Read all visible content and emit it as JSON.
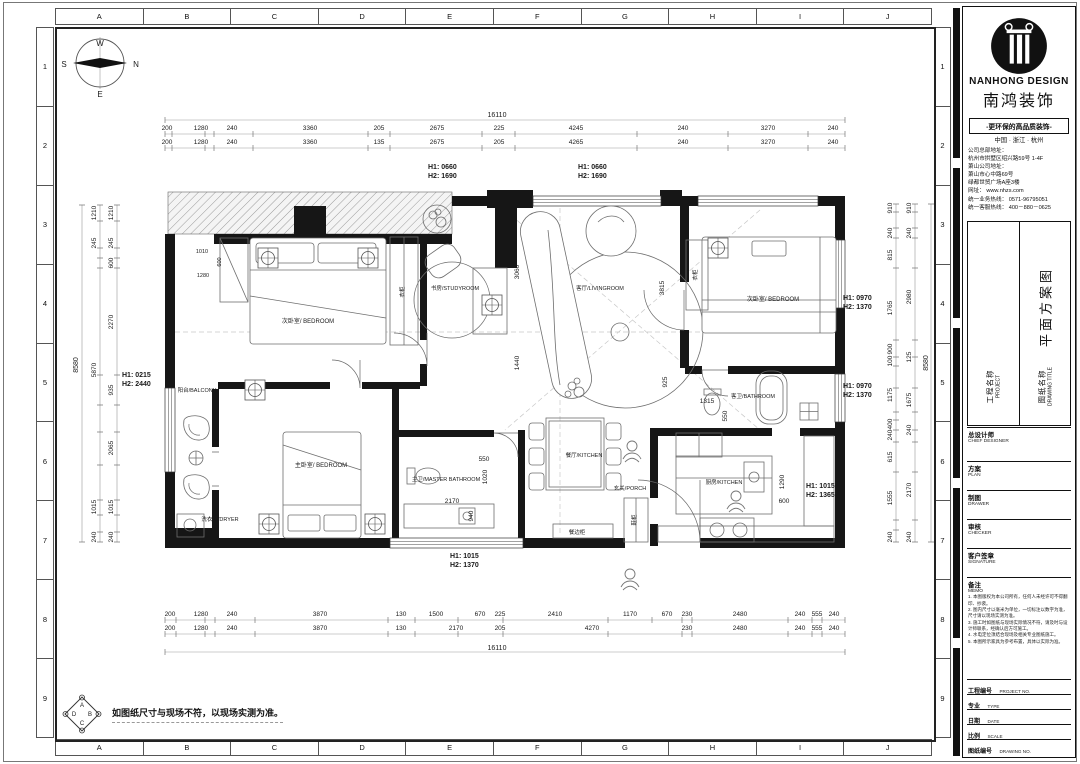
{
  "border": {
    "col_letters": [
      "A",
      "B",
      "C",
      "D",
      "E",
      "F",
      "G",
      "H",
      "I",
      "J"
    ],
    "row_numbers": [
      "1",
      "2",
      "3",
      "4",
      "5",
      "6",
      "7",
      "8",
      "9"
    ]
  },
  "note": {
    "text": "如图纸尺寸与现场不符，以现场实测为准。",
    "logo_letters": {
      "top": "A",
      "right": "B",
      "bottom": "C",
      "left": "D"
    }
  },
  "compass": {
    "w": "W",
    "s": "S",
    "n": "N",
    "e": "E"
  },
  "titleblock": {
    "brand_en": "NANHONG DESIGN",
    "brand_cn": "南鸿装饰",
    "slogan": "-更环保的高品质装饰-",
    "region": "中国 · 浙江 · 杭州",
    "addr_lines": [
      "公司总部地址：",
      "杭州市拱墅区绍兴路59号 1-4F",
      "萧山公司地址：",
      "萧山市心中路69号",
      "绿都世贸广场A座3楼",
      "网址： www.nhzs.com",
      "统一业务热线： 0571-96795051",
      "统一客服热线： 400－880－0625"
    ],
    "project_label": "工程名称",
    "project_label_en": "PROJECT",
    "drawing_label": "图纸名称",
    "drawing_label_en": "DRAWING TITLE",
    "drawing_title": "平面方案图",
    "chief": {
      "cn": "总设计师",
      "en": "CHIEF DESIGNER"
    },
    "rows": [
      {
        "cn": "方案",
        "en": "PLAN"
      },
      {
        "cn": "制图",
        "en": "DRAWER"
      },
      {
        "cn": "审核",
        "en": "CHECKER"
      },
      {
        "cn": "客户签章",
        "en": "SIGNATURE"
      }
    ],
    "memo": {
      "cn": "备注",
      "en": "MEMO"
    },
    "memo_items": [
      "1. 本图版权为本公司所有，任何人未经许可不得翻印、抄袭。",
      "2. 图内尺寸以毫米为单位，一切标注以数字为准，尺寸请以现场实测为准。",
      "3. 施工时如图纸与现场实际情况不符，请及时与设计师联系，经确认后方可施工。",
      "4. 水电定位须结合现场及相关专业图纸施工。",
      "5. 本图所示家具为参考布置，具体以实际为准。"
    ],
    "footer_rows": [
      {
        "cn": "工程编号",
        "en": "PROJECT NO."
      },
      {
        "cn": "专业",
        "en": "TYPE"
      },
      {
        "cn": "日期",
        "en": "DATE"
      },
      {
        "cn": "比例",
        "en": "SCALE"
      },
      {
        "cn": "图纸编号",
        "en": "DRAWING NO."
      }
    ]
  },
  "plan": {
    "labels": [
      {
        "t": "W",
        "x": 100,
        "y": 46,
        "c": "cmp"
      },
      {
        "t": "S",
        "x": 64,
        "y": 67,
        "c": "cmp"
      },
      {
        "t": "N",
        "x": 136,
        "y": 67,
        "c": "cmp"
      },
      {
        "t": "E",
        "x": 100,
        "y": 97,
        "c": "cmp"
      },
      {
        "t": "16110",
        "x": 497,
        "y": 117,
        "c": "big"
      },
      {
        "t": "200",
        "x": 167,
        "y": 130
      },
      {
        "t": "1280",
        "x": 201,
        "y": 130
      },
      {
        "t": "240",
        "x": 232,
        "y": 130
      },
      {
        "t": "3360",
        "x": 310,
        "y": 130
      },
      {
        "t": "205",
        "x": 379,
        "y": 130
      },
      {
        "t": "2675",
        "x": 437,
        "y": 130
      },
      {
        "t": "225",
        "x": 499,
        "y": 130
      },
      {
        "t": "4245",
        "x": 576,
        "y": 130
      },
      {
        "t": "240",
        "x": 683,
        "y": 130
      },
      {
        "t": "3270",
        "x": 768,
        "y": 130
      },
      {
        "t": "240",
        "x": 833,
        "y": 130
      },
      {
        "t": "200",
        "x": 167,
        "y": 144
      },
      {
        "t": "1280",
        "x": 201,
        "y": 144
      },
      {
        "t": "240",
        "x": 232,
        "y": 144
      },
      {
        "t": "3360",
        "x": 310,
        "y": 144
      },
      {
        "t": "135",
        "x": 379,
        "y": 144
      },
      {
        "t": "2675",
        "x": 437,
        "y": 144
      },
      {
        "t": "205",
        "x": 499,
        "y": 144
      },
      {
        "t": "4265",
        "x": 576,
        "y": 144
      },
      {
        "t": "240",
        "x": 683,
        "y": 144
      },
      {
        "t": "3270",
        "x": 768,
        "y": 144
      },
      {
        "t": "240",
        "x": 833,
        "y": 144
      },
      {
        "t": "H1: 0660",
        "x": 428,
        "y": 169,
        "c": "h",
        "n": "window-height-label"
      },
      {
        "t": "H2: 1690",
        "x": 428,
        "y": 178,
        "c": "h",
        "n": "window-height-label"
      },
      {
        "t": "H1: 0660",
        "x": 578,
        "y": 169,
        "c": "h",
        "n": "window-height-label"
      },
      {
        "t": "H2: 1690",
        "x": 578,
        "y": 178,
        "c": "h",
        "n": "window-height-label"
      },
      {
        "t": "200",
        "x": 170,
        "y": 616
      },
      {
        "t": "1280",
        "x": 201,
        "y": 616
      },
      {
        "t": "240",
        "x": 232,
        "y": 616
      },
      {
        "t": "3870",
        "x": 320,
        "y": 616
      },
      {
        "t": "130",
        "x": 401,
        "y": 616
      },
      {
        "t": "1500",
        "x": 436,
        "y": 616
      },
      {
        "t": "670",
        "x": 480,
        "y": 616
      },
      {
        "t": "225",
        "x": 500,
        "y": 616
      },
      {
        "t": "2410",
        "x": 555,
        "y": 616
      },
      {
        "t": "1170",
        "x": 630,
        "y": 616
      },
      {
        "t": "670",
        "x": 667,
        "y": 616
      },
      {
        "t": "230",
        "x": 687,
        "y": 616
      },
      {
        "t": "2480",
        "x": 740,
        "y": 616
      },
      {
        "t": "240",
        "x": 800,
        "y": 616
      },
      {
        "t": "555",
        "x": 817,
        "y": 616
      },
      {
        "t": "240",
        "x": 834,
        "y": 616
      },
      {
        "t": "200",
        "x": 170,
        "y": 630
      },
      {
        "t": "1280",
        "x": 201,
        "y": 630
      },
      {
        "t": "240",
        "x": 232,
        "y": 630
      },
      {
        "t": "3870",
        "x": 320,
        "y": 630
      },
      {
        "t": "130",
        "x": 401,
        "y": 630
      },
      {
        "t": "2170",
        "x": 456,
        "y": 630
      },
      {
        "t": "205",
        "x": 500,
        "y": 630
      },
      {
        "t": "4270",
        "x": 592,
        "y": 630
      },
      {
        "t": "230",
        "x": 687,
        "y": 630
      },
      {
        "t": "2480",
        "x": 740,
        "y": 630
      },
      {
        "t": "240",
        "x": 800,
        "y": 630
      },
      {
        "t": "555",
        "x": 817,
        "y": 630
      },
      {
        "t": "240",
        "x": 834,
        "y": 630
      },
      {
        "t": "16110",
        "x": 497,
        "y": 650,
        "c": "big"
      },
      {
        "t": "H1: 1015",
        "x": 450,
        "y": 558,
        "c": "h",
        "n": "window-height-label"
      },
      {
        "t": "H2: 1370",
        "x": 450,
        "y": 567,
        "c": "h",
        "n": "window-height-label"
      },
      {
        "t": "8580",
        "x": 78,
        "y": 365,
        "r": -90,
        "c": "big"
      },
      {
        "t": "1210",
        "x": 96,
        "y": 213,
        "r": -90
      },
      {
        "t": "245",
        "x": 96,
        "y": 243,
        "r": -90
      },
      {
        "t": "5870",
        "x": 96,
        "y": 370,
        "r": -90
      },
      {
        "t": "1015",
        "x": 96,
        "y": 507,
        "r": -90
      },
      {
        "t": "240",
        "x": 96,
        "y": 537,
        "r": -90
      },
      {
        "t": "1210",
        "x": 113,
        "y": 213,
        "r": -90
      },
      {
        "t": "245",
        "x": 113,
        "y": 243,
        "r": -90
      },
      {
        "t": "600",
        "x": 113,
        "y": 263,
        "r": -90
      },
      {
        "t": "2270",
        "x": 113,
        "y": 322,
        "r": -90
      },
      {
        "t": "935",
        "x": 113,
        "y": 390,
        "r": -90
      },
      {
        "t": "2065",
        "x": 113,
        "y": 448,
        "r": -90
      },
      {
        "t": "1015",
        "x": 113,
        "y": 507,
        "r": -90
      },
      {
        "t": "240",
        "x": 113,
        "y": 537,
        "r": -90
      },
      {
        "t": "H1: 0215",
        "x": 122,
        "y": 377,
        "c": "h",
        "n": "window-height-label"
      },
      {
        "t": "H2: 2440",
        "x": 122,
        "y": 386,
        "c": "h",
        "n": "window-height-label"
      },
      {
        "t": "8580",
        "x": 928,
        "y": 363,
        "r": -90,
        "c": "big"
      },
      {
        "t": "910",
        "x": 892,
        "y": 208,
        "r": -90
      },
      {
        "t": "240",
        "x": 892,
        "y": 233,
        "r": -90
      },
      {
        "t": "815",
        "x": 892,
        "y": 255,
        "r": -90
      },
      {
        "t": "1765",
        "x": 892,
        "y": 308,
        "r": -90
      },
      {
        "t": "900",
        "x": 892,
        "y": 349,
        "r": -90
      },
      {
        "t": "100",
        "x": 892,
        "y": 361,
        "r": -90
      },
      {
        "t": "1175",
        "x": 892,
        "y": 395,
        "r": -90
      },
      {
        "t": "400",
        "x": 892,
        "y": 424,
        "r": -90
      },
      {
        "t": "240",
        "x": 892,
        "y": 435,
        "r": -90
      },
      {
        "t": "615",
        "x": 892,
        "y": 457,
        "r": -90
      },
      {
        "t": "1555",
        "x": 892,
        "y": 498,
        "r": -90
      },
      {
        "t": "240",
        "x": 892,
        "y": 537,
        "r": -90
      },
      {
        "t": "910",
        "x": 911,
        "y": 208,
        "r": -90
      },
      {
        "t": "240",
        "x": 911,
        "y": 233,
        "r": -90
      },
      {
        "t": "2980",
        "x": 911,
        "y": 297,
        "r": -90
      },
      {
        "t": "125",
        "x": 911,
        "y": 357,
        "r": -90
      },
      {
        "t": "1675",
        "x": 911,
        "y": 400,
        "r": -90
      },
      {
        "t": "240",
        "x": 911,
        "y": 430,
        "r": -90
      },
      {
        "t": "2170",
        "x": 911,
        "y": 490,
        "r": -90
      },
      {
        "t": "240",
        "x": 911,
        "y": 537,
        "r": -90
      },
      {
        "t": "H1: 0970",
        "x": 843,
        "y": 300,
        "c": "h",
        "n": "window-height-label"
      },
      {
        "t": "H2: 1370",
        "x": 843,
        "y": 309,
        "c": "h",
        "n": "window-height-label"
      },
      {
        "t": "H1: 0970",
        "x": 843,
        "y": 388,
        "c": "h",
        "n": "window-height-label"
      },
      {
        "t": "H2: 1370",
        "x": 843,
        "y": 397,
        "c": "h",
        "n": "window-height-label"
      },
      {
        "t": "1010",
        "x": 202,
        "y": 253,
        "c": "t"
      },
      {
        "t": "600",
        "x": 221,
        "y": 262,
        "r": -90,
        "c": "t"
      },
      {
        "t": "1280",
        "x": 203,
        "y": 277,
        "c": "t"
      },
      {
        "t": "3060",
        "x": 519,
        "y": 272,
        "r": -90
      },
      {
        "t": "1440",
        "x": 519,
        "y": 363,
        "r": -90
      },
      {
        "t": "3815",
        "x": 664,
        "y": 288,
        "r": -90
      },
      {
        "t": "925",
        "x": 667,
        "y": 382,
        "r": -90
      },
      {
        "t": "550",
        "x": 484,
        "y": 461
      },
      {
        "t": "1020",
        "x": 487,
        "y": 477,
        "r": -90
      },
      {
        "t": "2170",
        "x": 452,
        "y": 503
      },
      {
        "t": "940",
        "x": 473,
        "y": 516,
        "r": -90
      },
      {
        "t": "1315",
        "x": 707,
        "y": 403
      },
      {
        "t": "550",
        "x": 727,
        "y": 416,
        "r": -90
      },
      {
        "t": "1290",
        "x": 784,
        "y": 482,
        "r": -90
      },
      {
        "t": "600",
        "x": 784,
        "y": 503
      },
      {
        "t": "H1: 1015",
        "x": 806,
        "y": 488,
        "c": "h",
        "n": "window-height-label"
      },
      {
        "t": "H2: 1365",
        "x": 806,
        "y": 497,
        "c": "h",
        "n": "window-height-label"
      },
      {
        "t": "次卧室/ BEDROOM",
        "x": 308,
        "y": 323,
        "c": "r",
        "n": "room-label"
      },
      {
        "t": "书房/STUDYROOM",
        "x": 455,
        "y": 290,
        "c": "t",
        "n": "room-label"
      },
      {
        "t": "客厅/LIVINGROOM",
        "x": 600,
        "y": 290,
        "c": "t",
        "n": "room-label"
      },
      {
        "t": "次卧室/ BEDROOM",
        "x": 773,
        "y": 301,
        "c": "r",
        "n": "room-label"
      },
      {
        "t": "阳台/BALCONY",
        "x": 197,
        "y": 392,
        "c": "t",
        "n": "room-label"
      },
      {
        "t": "主卧室/ BEDROOM",
        "x": 321,
        "y": 467,
        "c": "r",
        "n": "room-label"
      },
      {
        "t": "主卫/MASTER BATHROOM",
        "x": 446,
        "y": 481,
        "c": "t",
        "n": "room-label"
      },
      {
        "t": "餐厅/KITCHEN",
        "x": 584,
        "y": 457,
        "c": "t",
        "n": "room-label"
      },
      {
        "t": "玄关/PORCH",
        "x": 630,
        "y": 490,
        "c": "t",
        "n": "room-label"
      },
      {
        "t": "厨房/KITCHEN",
        "x": 724,
        "y": 484,
        "c": "t",
        "n": "room-label"
      },
      {
        "t": "客卫/BATHROOM",
        "x": 753,
        "y": 398,
        "c": "t",
        "n": "room-label"
      },
      {
        "t": "洗衣机/DRYER",
        "x": 220,
        "y": 521,
        "c": "t",
        "n": "appliance-label"
      },
      {
        "t": "餐边柜",
        "x": 577,
        "y": 534,
        "c": "t",
        "n": "cabinet-label"
      },
      {
        "t": "鞋柜",
        "x": 636,
        "y": 520,
        "r": -90,
        "c": "t",
        "n": "cabinet-label"
      },
      {
        "t": "衣柜",
        "x": 404,
        "y": 292,
        "r": -90,
        "c": "t",
        "n": "cabinet-label"
      },
      {
        "t": "衣柜",
        "x": 697,
        "y": 275,
        "r": -90,
        "c": "t",
        "n": "cabinet-label"
      }
    ]
  }
}
